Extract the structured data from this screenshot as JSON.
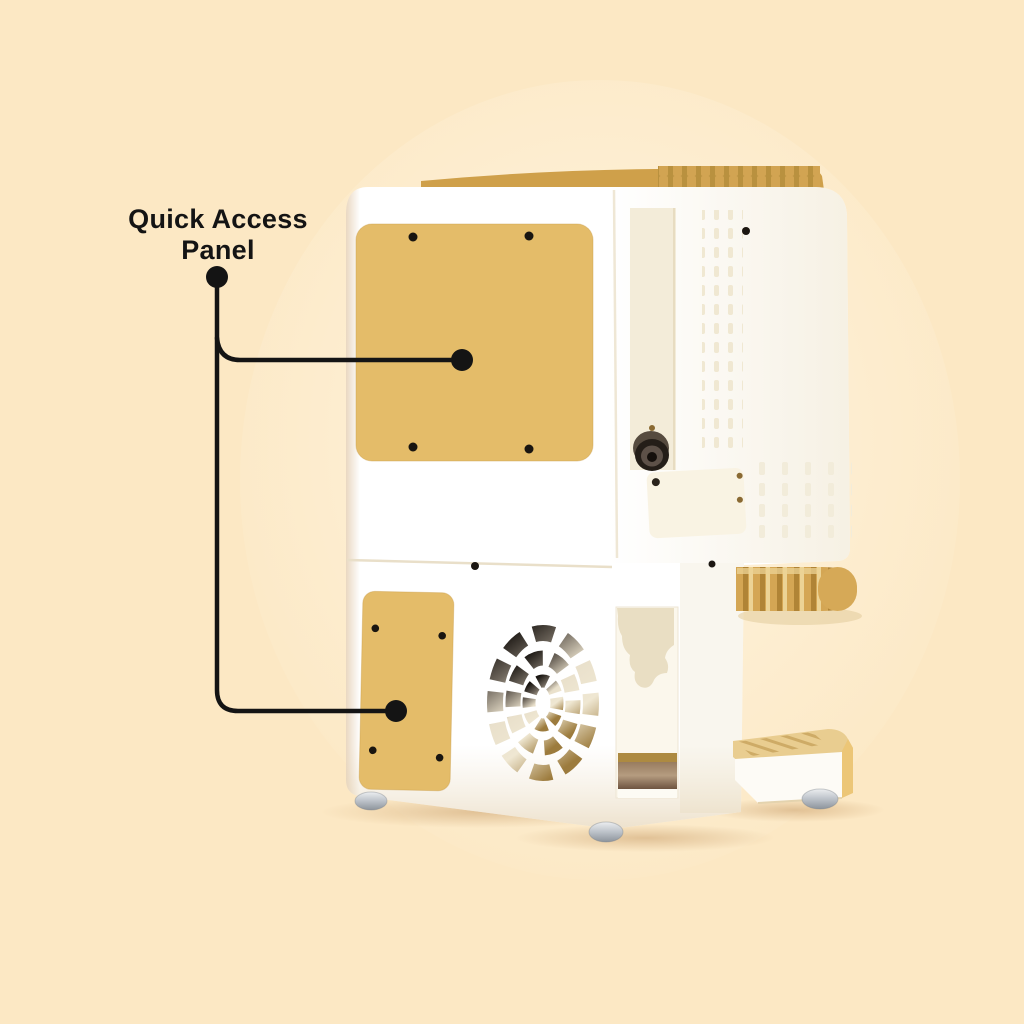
{
  "page": {
    "background_color": "#fce8c4"
  },
  "annotation": {
    "label": "Quick Access Panel",
    "label_color": "#141414",
    "line_color": "#141414",
    "targets": [
      "upper-access-panel",
      "lower-access-panel"
    ]
  },
  "machine": {
    "kind": "compact espresso machine, rear three-quarter product view",
    "body_color": "#ffffff",
    "panel_gold": "#e4bc69",
    "trim_gold": "#cfa04a",
    "handle_gold": "#d4a654",
    "tray_gold": "#e9cd90",
    "screw_color": "#1b1611",
    "parts": [
      "top-vent-strip",
      "upper-access-panel",
      "lower-access-panel",
      "fan-grille",
      "camera-lens",
      "lens-channel",
      "service-panel",
      "vent-grid-upper",
      "vent-grid-lower",
      "window-cutout",
      "portafilter-handle",
      "drip-tray",
      "machine-feet"
    ]
  }
}
